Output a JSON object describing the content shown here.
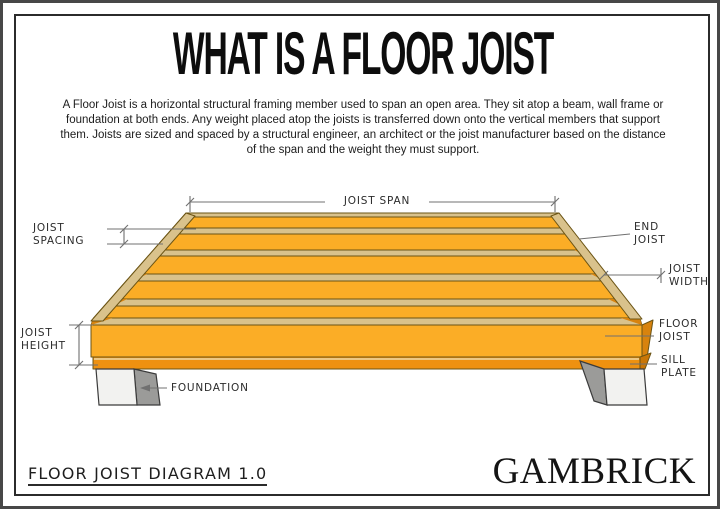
{
  "page": {
    "title": "WHAT IS A FLOOR JOIST",
    "description": "A Floor Joist is a horizontal structural framing member used to span an open area. They sit atop a beam, wall frame or foundation at both ends. Any weight placed atop the joists is transferred down onto the vertical members that support them. Joists are sized and spaced by a structural engineer, an architect or the joist manufacturer based on the distance of the span and the weight they must support."
  },
  "diagram": {
    "labels": {
      "joist_span": "JOIST SPAN",
      "joist_spacing": [
        "JOIST",
        "SPACING"
      ],
      "end_joist": [
        "END",
        "JOIST"
      ],
      "joist_width": [
        "JOIST",
        "WIDTH"
      ],
      "floor_joist": [
        "FLOOR",
        "JOIST"
      ],
      "sill_plate": [
        "SILL",
        "PLATE"
      ],
      "joist_height": [
        "JOIST",
        "HEIGHT"
      ],
      "foundation": "FOUNDATION"
    }
  },
  "footer": {
    "doc_title": "FLOOR JOIST DIAGRAM 1.0",
    "brand": "GAMBRICK"
  },
  "colors": {
    "joist_face": "#FBAD26",
    "joist_edge_tan": "#D9C28C",
    "joist_shadow": "#D8830E",
    "joist_shadow_dark": "#C97607",
    "sill": "#EE9110",
    "wood_outline": "#6B5414",
    "pier_face": "#F2F2F0",
    "pier_side": "#9B9B99",
    "pier_outline": "#3B3B3B",
    "dim_line": "#707070",
    "label_text": "#2B2B2B"
  }
}
